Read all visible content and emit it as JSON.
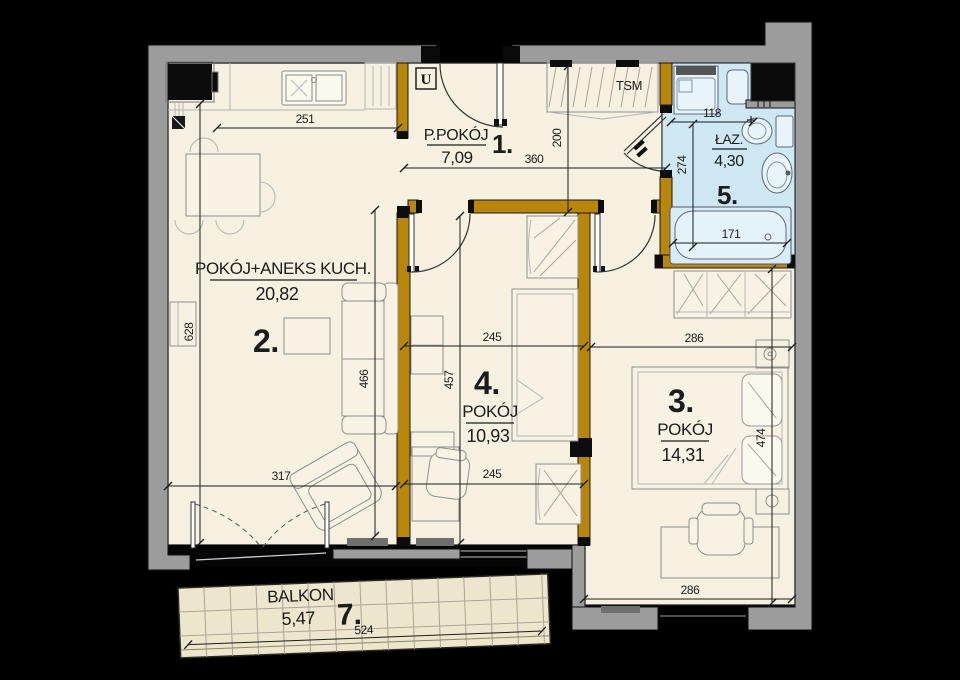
{
  "rooms": [
    {
      "number": "1.",
      "name": "P.POKÓJ",
      "area": "7,09"
    },
    {
      "number": "2.",
      "name": "POKÓJ+ANEKS KUCH.",
      "area": "20,82"
    },
    {
      "number": "3.",
      "name": "POKÓJ",
      "area": "14,31"
    },
    {
      "number": "4.",
      "name": "POKÓJ",
      "area": "10,93"
    },
    {
      "number": "5.",
      "name": "ŁAZ.",
      "area": "4,30"
    },
    {
      "number": "7.",
      "name": "BALKON",
      "area": "5,47"
    }
  ],
  "labels": {
    "entry_marker": "U",
    "wardrobe_marker": "TSM"
  },
  "dimensions_cm": {
    "kitchen_counter": "251",
    "hall_width": "360",
    "hall_depth": "200",
    "bath_top": "118",
    "bath_side": "274",
    "bath_tub": "171",
    "room2_left": "628",
    "room2_right": "466",
    "room2_bottom": "317",
    "room4_top": "245",
    "room4_side": "457",
    "room4_bottom": "245",
    "room3_top": "286",
    "room3_side": "474",
    "room3_bottom": "286",
    "balcony": "524"
  },
  "colors": {
    "background": "#000000",
    "floor": "#f5f0e0",
    "bathroom": "#cde7f3",
    "wall_outer": "#9c9c9c",
    "wall_inner": "#b8860b",
    "balcony": "#ece6cd"
  }
}
